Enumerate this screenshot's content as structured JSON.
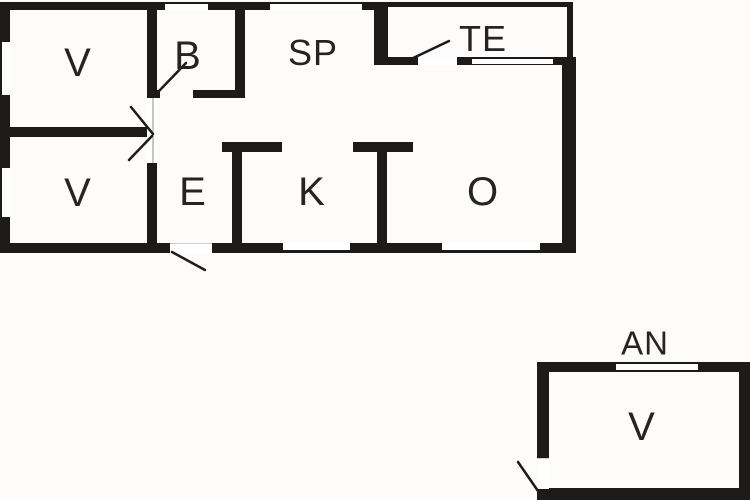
{
  "colors": {
    "wall": "#1d1b1a",
    "background": "#fdfcfa",
    "label": "#262423"
  },
  "main_house": {
    "rooms": [
      {
        "id": "v1",
        "label": "V"
      },
      {
        "id": "b",
        "label": "B"
      },
      {
        "id": "sp",
        "label": "SP"
      },
      {
        "id": "te",
        "label": "TE"
      },
      {
        "id": "v2",
        "label": "V"
      },
      {
        "id": "e",
        "label": "E"
      },
      {
        "id": "k",
        "label": "K"
      },
      {
        "id": "o",
        "label": "O"
      }
    ]
  },
  "annex": {
    "label": "AN",
    "rooms": [
      {
        "id": "v3",
        "label": "V"
      }
    ]
  }
}
